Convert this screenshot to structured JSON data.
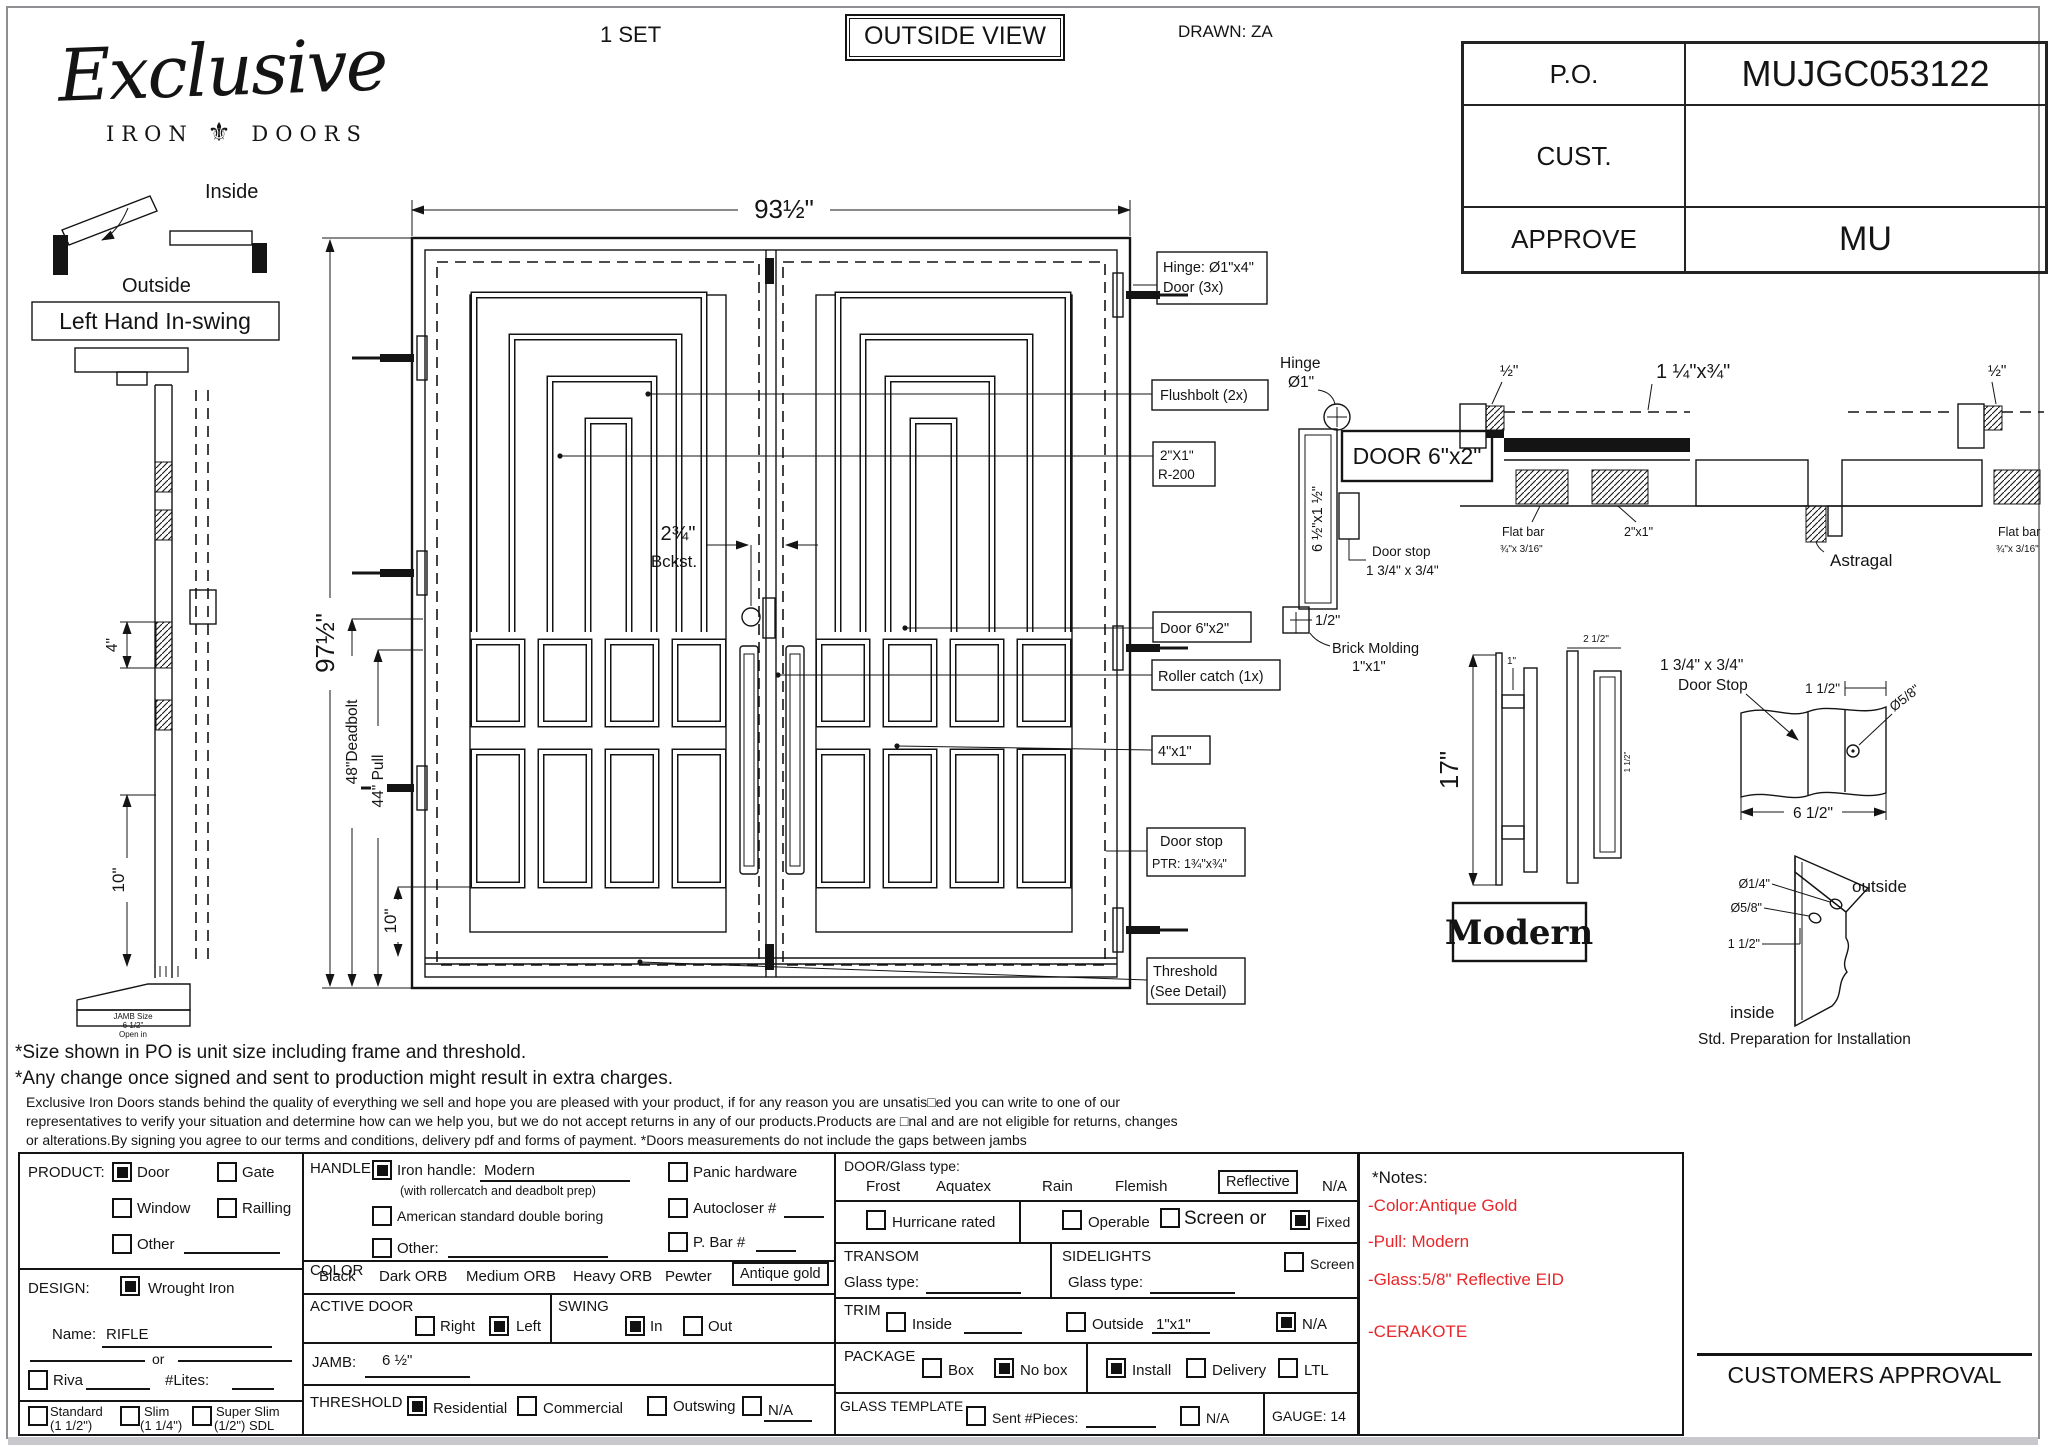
{
  "header": {
    "set_count": "1 SET",
    "view": "OUTSIDE VIEW",
    "drawn": "DRAWN: ZA"
  },
  "logo": {
    "name": "Exclusive",
    "sub_left": "IRON",
    "ornament": "⚜",
    "sub_right": "DOORS"
  },
  "po_table": {
    "po_label": "P.O.",
    "po_value": "MUJGC053122",
    "cust_label": "CUST.",
    "cust_value": "",
    "approve_label": "APPROVE",
    "approve_value": "MU"
  },
  "swing_diagram": {
    "inside": "Inside",
    "outside": "Outside",
    "handing": "Left Hand In-swing"
  },
  "side_profile": {
    "dim_top": "4\"",
    "dim_bottom": "10\"",
    "jamb_line1": "JAMB Size",
    "jamb_line2": "6 1/2\"",
    "jamb_line3": "Open in"
  },
  "elevation": {
    "width_dim": "93½\"",
    "height_dim": "97½\"",
    "backset_value": "2¾\"",
    "backset_label": "Bckst.",
    "deadbolt_dim": "48\"Deadbolt",
    "pull_dim": "44\" Pull",
    "bottom_rail_dim": "10\"",
    "callouts": {
      "hinge1": "Hinge: Ø1\"x4\"",
      "hinge2": "Door (3x)",
      "flushbolt": "Flushbolt (2x)",
      "r200a": "2\"X1\"",
      "r200b": "R-200",
      "door_tube": "Door 6\"x2\"",
      "roller": "Roller catch  (1x)",
      "bar": "4\"x1\"",
      "stop1": "Door stop",
      "stop2": "PTR: 1¾\"x¾\"",
      "threshold1": "Threshold",
      "threshold2": "(See Detail)"
    }
  },
  "jamb_section": {
    "hinge1": "Hinge",
    "hinge2": "Ø1\"",
    "door_tube": "DOOR 6\"x2\"",
    "jamb_size": "6 ½\"x1 ½\"",
    "stop1": "Door stop",
    "stop2": "1 3/4\" x 3/4\"",
    "half": "1/2\"",
    "brick1": "Brick Molding",
    "brick2": "1\"x1\""
  },
  "head_section": {
    "half_left": "½\"",
    "astragal_bar": "1 ¼\"x¾\"",
    "half_right": "½\"",
    "flat_bar1": "Flat bar",
    "flat_bar2": "¾\"x 3/16\"",
    "tube": "2\"x1\"",
    "astragal": "Astragal",
    "flat_bar_r1": "Flat bar",
    "flat_bar_r2": "¾\"x 3/16\""
  },
  "handle_detail": {
    "height": "17\"",
    "dim1": "1\"",
    "dim2": "2 1/2\"",
    "dim3": "1 1/2\"",
    "name": "Modern"
  },
  "stop_detail": {
    "label1": "1 3/4\" x 3/4\"",
    "label2": "Door Stop",
    "dim1": "1 1/2\"",
    "dia": "Ø5/8\"",
    "width": "6 1/2\""
  },
  "prep_detail": {
    "dia1": "Ø1/4\"",
    "dia2": "Ø5/8\"",
    "dim": "1 1/2\"",
    "outside": "outside",
    "inside": "inside",
    "caption": "Std. Preparation for Installation"
  },
  "disclaimer": {
    "line1": "*Size shown in PO is unit size including frame and threshold.",
    "line2": "*Any change once signed and sent to production might result in extra charges.",
    "para1": "Exclusive Iron Doors stands behind the quality of everything we sell and hope you are pleased with your product, if for any reason you are unsatis□ed you can write to one of our",
    "para2": "representatives to verify your situation and determine how can we help you, but we do not accept returns in any of our products.Products are □nal and are not eligible for returns, changes",
    "para3": "or alterations.By signing you agree to our terms and conditions, delivery pdf and forms of payment. *Doors measurements do not include the gaps between jambs"
  },
  "form": {
    "product": {
      "label": "PRODUCT:",
      "door": "Door",
      "gate": "Gate",
      "window": "Window",
      "railling": "Railling",
      "other": "Other"
    },
    "design": {
      "label": "DESIGN:",
      "wrought": "Wrought Iron",
      "name_label": "Name:",
      "name_value": "RIFLE",
      "or_label": "or",
      "riva": "Riva",
      "lites": "#Lites:",
      "t1a": "Standard",
      "t1b": "(1 1/2\")",
      "t2a": "Slim",
      "t2b": "(1 1/4\")",
      "t3a": "Super Slim",
      "t3b": "(1/2\") SDL"
    },
    "handle": {
      "label": "HANDLE",
      "iron": "Iron handle:",
      "iron_value": "Modern",
      "iron_sub": "(with rollercatch and deadbolt prep)",
      "american": "American standard double boring",
      "other": "Other:",
      "panic": "Panic hardware",
      "autocloser": "Autocloser #",
      "pbar": "P. Bar #"
    },
    "color": {
      "label": "COLOR",
      "o1": "Black",
      "o2": "Dark ORB",
      "o3": "Medium ORB",
      "o4": "Heavy ORB",
      "o5": "Pewter",
      "selected": "Antique gold"
    },
    "active_door": {
      "label": "ACTIVE DOOR",
      "right": "Right",
      "left": "Left"
    },
    "swing": {
      "label": "SWING",
      "in": "In",
      "out": "Out"
    },
    "jamb": {
      "label": "JAMB:",
      "value": "6 ½\""
    },
    "threshold": {
      "label": "THRESHOLD",
      "residential": "Residential",
      "commercial": "Commercial",
      "outswing": "Outswing",
      "na": "N/A"
    },
    "glass": {
      "label": "DOOR/Glass type:",
      "o1": "Frost",
      "o2": "Aquatex",
      "o3": "Rain",
      "o4": "Flemish",
      "selected": "Reflective",
      "na": "N/A",
      "hurricane": "Hurricane rated",
      "operable": "Operable",
      "screen_or": "Screen or",
      "fixed": "Fixed"
    },
    "transom": {
      "label": "TRANSOM",
      "glass_label": "Glass type:"
    },
    "sidelights": {
      "label": "SIDELIGHTS",
      "glass_label": "Glass type:",
      "screen": "Screen"
    },
    "trim": {
      "label": "TRIM",
      "inside": "Inside",
      "outside": "Outside",
      "outside_value": "1\"x1\"",
      "na": "N/A"
    },
    "package": {
      "label": "PACKAGE",
      "box": "Box",
      "no_box": "No box",
      "install": "Install",
      "delivery": "Delivery",
      "ltl": "LTL"
    },
    "template": {
      "label": "GLASS TEMPLATE",
      "sent": "Sent #Pieces:",
      "na": "N/A",
      "gauge": "GAUGE: 14"
    },
    "notes": {
      "title": "*Notes:",
      "n1": "-Color:Antique Gold",
      "n2": "-Pull: Modern",
      "n3": "-Glass:5/8\" Reflective EID",
      "n4": "-CERAKOTE"
    }
  },
  "approval": "CUSTOMERS APPROVAL",
  "checks": {
    "door": true,
    "gate": false,
    "window": false,
    "railling": false,
    "other_product": false,
    "wrought_iron": true,
    "riva": false,
    "standard": false,
    "slim": false,
    "super_slim": false,
    "iron_handle": true,
    "american": false,
    "other_handle": false,
    "panic": false,
    "autocloser": false,
    "pbar": false,
    "right": false,
    "left": true,
    "swing_in": true,
    "swing_out": false,
    "residential": true,
    "commercial": false,
    "outswing": false,
    "threshold_na": false,
    "hurricane": false,
    "operable": false,
    "screen": false,
    "fixed": true,
    "sidelight_screen": false,
    "trim_inside": false,
    "trim_outside": false,
    "trim_na": true,
    "box": false,
    "no_box": true,
    "install": true,
    "delivery": false,
    "ltl": false,
    "sent": false,
    "template_na": false
  }
}
